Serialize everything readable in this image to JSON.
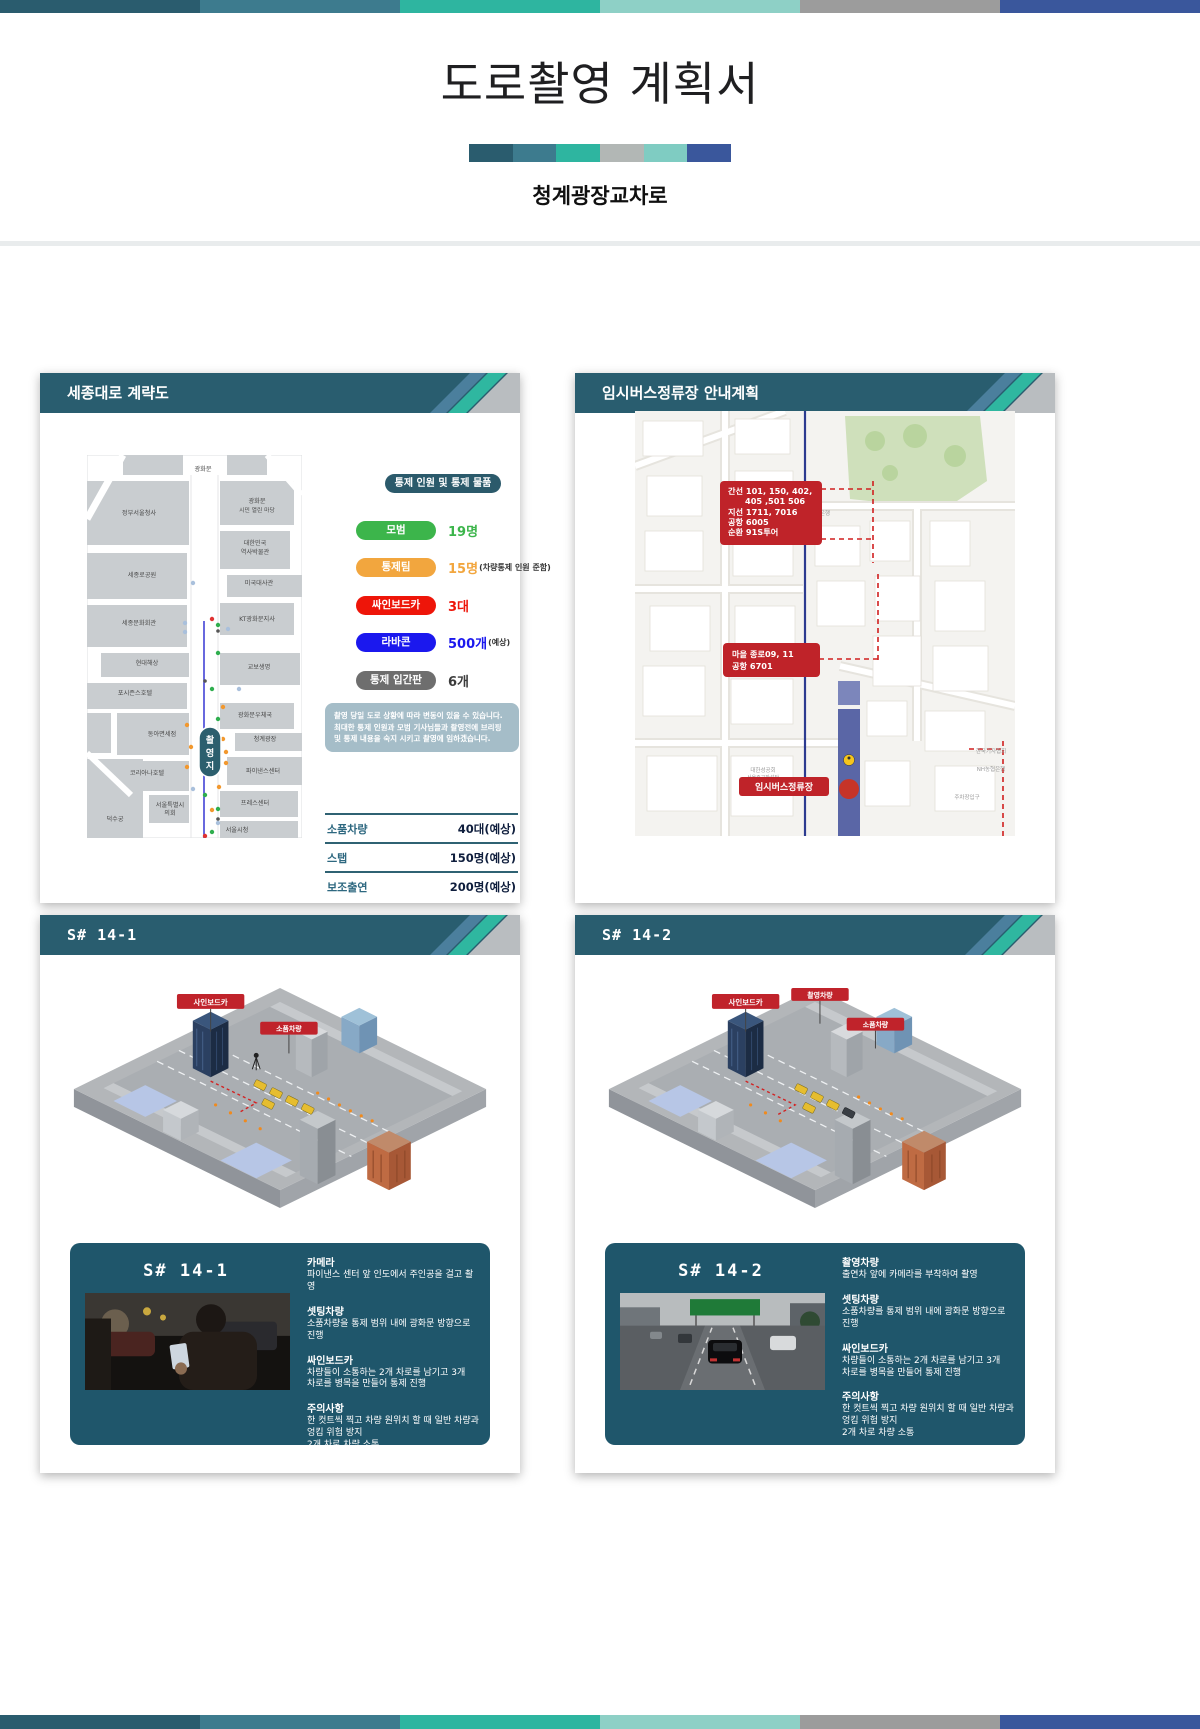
{
  "page": {
    "title": "도로촬영 계획서",
    "subtitle": "청계광장교차로",
    "top_bar_colors": [
      "#2a5c6e",
      "#3d7b8e",
      "#2eb5a0",
      "#8ed0c6",
      "#9c9c9c",
      "#3a579c"
    ],
    "title_bar_colors": [
      "#2a5c6e",
      "#3d7b8e",
      "#2eb5a0",
      "#b2b7b5",
      "#7fccc2",
      "#3a579c"
    ],
    "header_color": "#295d6f",
    "accent_red": "#bf2329"
  },
  "panel1": {
    "header": "세종대로 계략도",
    "legend_title": "통제 인원 및 통제 물품",
    "legend": [
      {
        "label": "모범",
        "value": "19명",
        "suffix": "",
        "color": "#3cb54b"
      },
      {
        "label": "통제팀",
        "value": "15명",
        "suffix": "(차량통제 인원 준함)",
        "color": "#f2a63e"
      },
      {
        "label": "싸인보드카",
        "value": "3대",
        "suffix": "",
        "color": "#ee1509"
      },
      {
        "label": "라바콘",
        "value": "500개",
        "suffix": "(예상)",
        "color": "#1b18ee"
      },
      {
        "label": "통제 입간판",
        "value": "6개",
        "suffix": "",
        "color": "#6e6e6e"
      }
    ],
    "note": "촬영 당일 도로 상황에 따라 변동이 있을 수 있습니다. 최대한 통제 인원과 모범 기사님들과 촬영전에 브리핑 및 통제 내용을 숙지 시키고 촬영에 임하겠습니다.",
    "table": [
      {
        "label": "소품차량",
        "value": "40대(예상)"
      },
      {
        "label": "스탭",
        "value": "150명(예상)"
      },
      {
        "label": "보조출연",
        "value": "200명(예상)"
      }
    ],
    "site": [
      "촬",
      "영",
      "지"
    ],
    "map_labels": [
      "광화문",
      "정부서울청사",
      "광화문",
      "시민 열린 마당",
      "대한민국",
      "역사박물관",
      "세종로공원",
      "미국대사관",
      "세종문화회관",
      "KT광화문지사",
      "현대해상",
      "교보생명",
      "포시즌스호텔",
      "광화문우체국",
      "동아면세점",
      "청계광장",
      "코리아나호텔",
      "파이낸스센터",
      "서울특별시",
      "의회",
      "프레스센터",
      "덕수궁",
      "서울시청"
    ]
  },
  "panel2": {
    "header": "임시버스정류장 안내계획",
    "route_box1_lines": [
      "간선 101, 150, 402,",
      "405 ,501  506",
      "지선 1711, 7016",
      "공항 6005",
      "순환 91S투어"
    ],
    "route_box2_lines": [
      "마을 종로09, 11",
      "공항 6701"
    ],
    "stop_label": "임시버스정류장",
    "map_labels": [
      "신한은행",
      "대한성공회",
      "서울주교좌성당",
      "한국기자협회",
      "NH농협은행",
      "주차장입구"
    ]
  },
  "panel3": {
    "header": "S# 14-1",
    "card_title": "S# 14-1",
    "flags": [
      "사인보드카",
      "소품차량"
    ],
    "sections": [
      {
        "title": "카메라",
        "body": "파이낸스 센터 앞 인도에서 주인공을 걸고 촬영"
      },
      {
        "title": "셋팅차량",
        "body": "소품차량을 통제 범위 내에 광화문 방향으로 진행"
      },
      {
        "title": "싸인보드카",
        "body": "차량들이 소통하는 2개 차로를 남기고 3개\n차로를 병목을 만들어 통제 진행"
      },
      {
        "title": "주의사항",
        "body": "한 컷트씩 찍고 차량 원위치 할 때 일반 차량과\n엉킴 위험 방지\n2개 차로 차량 소통"
      }
    ]
  },
  "panel4": {
    "header": "S# 14-2",
    "card_title": "S# 14-2",
    "flags": [
      "사인보드카",
      "촬영차량",
      "소품차량"
    ],
    "sections": [
      {
        "title": "촬영차량",
        "body": "출연차 앞에 카메라를 부착하여 촬영"
      },
      {
        "title": "셋팅차량",
        "body": "소품차량를 통제 범위 내에 광화문 방향으로 진행"
      },
      {
        "title": "싸인보드카",
        "body": "차량들이 소통하는 2개 차로를 남기고 3개\n차로를 병목을 만들어 통제 진행"
      },
      {
        "title": "주의사항",
        "body": "한 컷트씩 찍고 차량 원위치 할 때 일반 차량과\n엉킴 위험 방지\n2개 차로 차량 소통"
      }
    ]
  }
}
